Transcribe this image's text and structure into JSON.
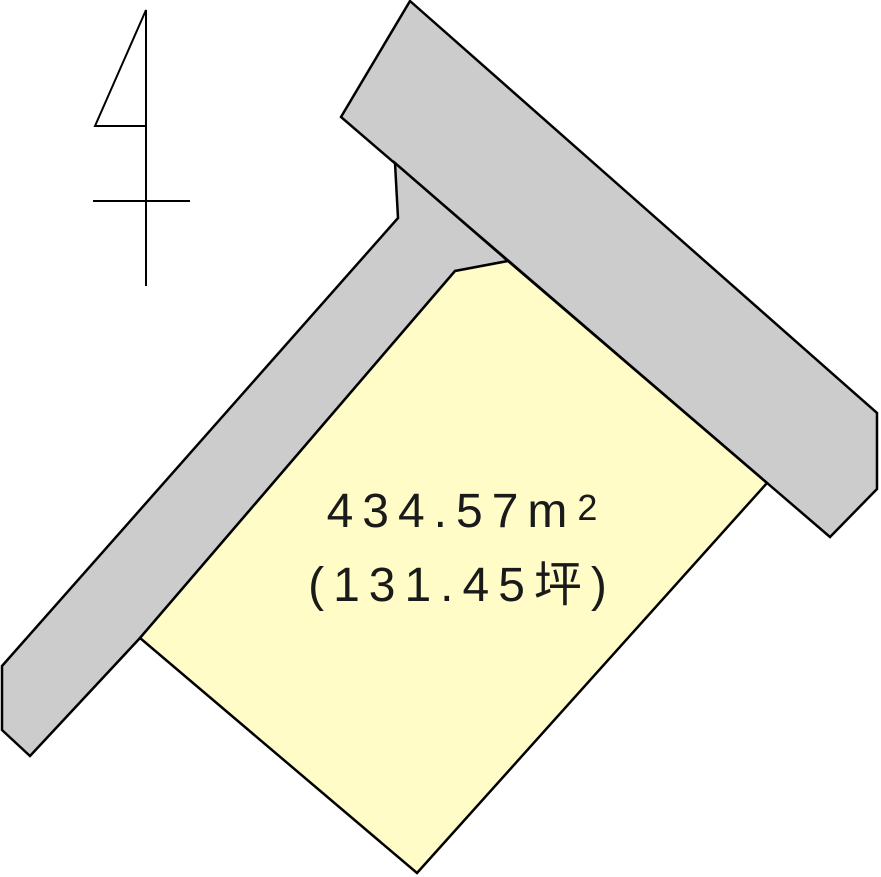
{
  "page": {
    "background": "#ffffff"
  },
  "colors": {
    "road_fill": "#cccccc",
    "parcel_fill": "#fffcc8",
    "outline": "#000000",
    "text": "#1a1a1a"
  },
  "icons": {
    "north_arrow": "north-arrow-icon"
  },
  "label": {
    "area_sqm_value": "434.57",
    "area_sqm_unit_base": "m",
    "area_sqm_unit_exponent": "2",
    "area_tsubo": "(131.45坪)"
  }
}
